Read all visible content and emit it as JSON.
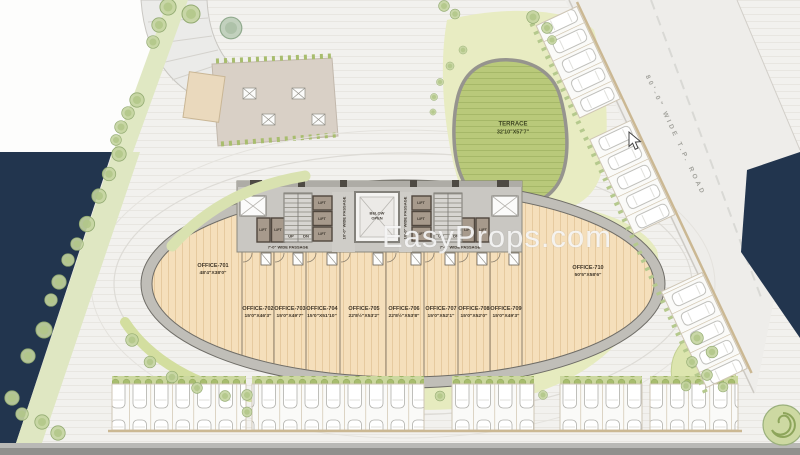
{
  "watermark": "EasyProps.com",
  "road": {
    "label": "80'-0\" WIDE T.P. ROAD"
  },
  "terrace": {
    "name": "TERRACE",
    "dims": "32'10\"X57'7\""
  },
  "atrium": {
    "line1": "BELOW",
    "line2": "OPEN"
  },
  "core": {
    "lift": "LIFT",
    "up": "UP",
    "dn": "DN",
    "passage7": "7'-0\" WIDE PASSAGE",
    "passage10": "10'-0\" WIDE PASSAGE"
  },
  "offices": [
    {
      "name": "OFFICE-701",
      "dims": "48'4\"X38'0\""
    },
    {
      "name": "OFFICE-702",
      "dims": "15'0\"X46'3\""
    },
    {
      "name": "OFFICE-703",
      "dims": "15'0\"X49'7\""
    },
    {
      "name": "OFFICE-704",
      "dims": "15'0\"X51'10\""
    },
    {
      "name": "OFFICE-705",
      "dims": "22'8½\"X53'2\""
    },
    {
      "name": "OFFICE-706",
      "dims": "22'8½\"X53'8\""
    },
    {
      "name": "OFFICE-707",
      "dims": "15'0\"X52'1\""
    },
    {
      "name": "OFFICE-708",
      "dims": "15'0\"X52'0\""
    },
    {
      "name": "OFFICE-709",
      "dims": "15'0\"X49'3\""
    },
    {
      "name": "OFFICE-710",
      "dims": "50'5\"X58'6\""
    }
  ],
  "colors": {
    "navy": "#22354e",
    "floor": "#f5dfbb",
    "terrace_green": "#b9c97a",
    "lawn": "#e7ecc2",
    "accent_wall": "#cbb893"
  }
}
